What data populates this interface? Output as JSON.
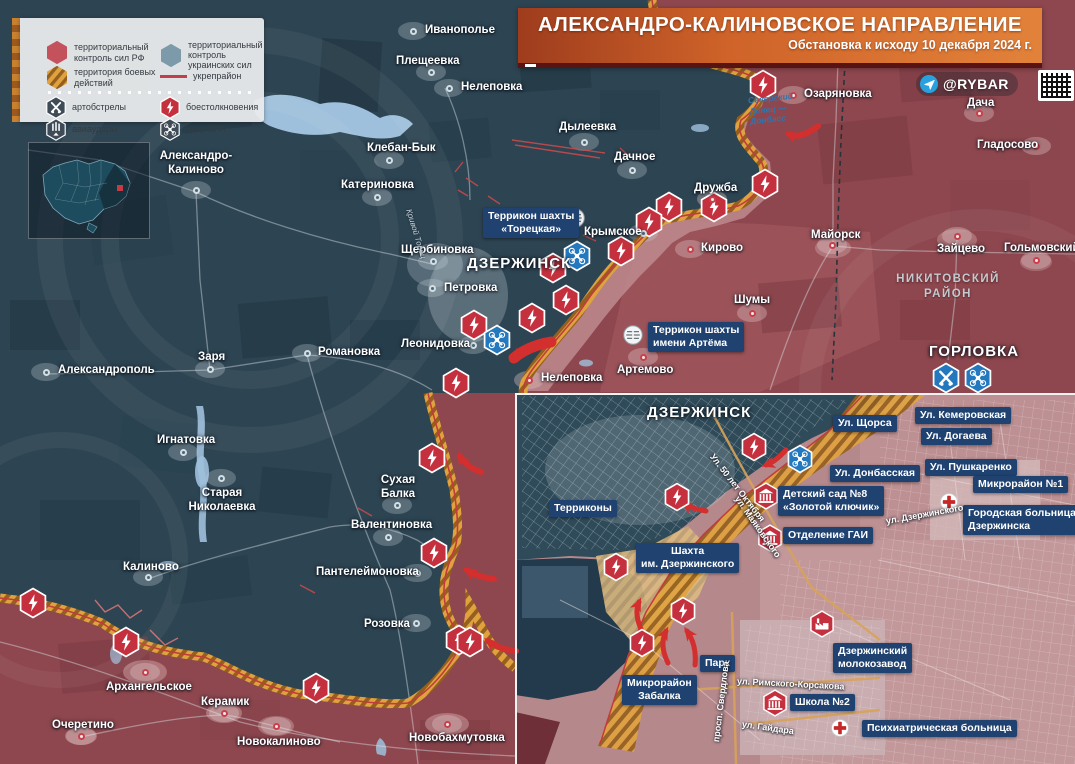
{
  "header": {
    "title": "АЛЕКСАНДРО-КАЛИНОВСКОЕ НАПРАВЛЕНИЕ",
    "subtitle": "Обстановка к исходу 10 декабря 2024 г.",
    "badge": "@RYBAR"
  },
  "legend": {
    "rf_control": "территориальный контроль сил РФ",
    "ua_control": "территориальный контроль украинских сил",
    "combat_zone": "территория боевых действий",
    "fortified": "укрепрайон",
    "artillery": "артобстрелы",
    "clashes": "боестолкновения",
    "airstrikes": "авиаудары",
    "uav": "удар БЛА"
  },
  "colors": {
    "rf_area": "#8e474e",
    "ua_area": "#2d4452",
    "combat_band": "#e0a23f",
    "accent_red": "#c5303e",
    "accent_blue": "#2478bd",
    "box_blue": "#1f4270"
  },
  "map": {
    "cities": [
      {
        "name": "Иванополье",
        "lx": 425,
        "ly": 24,
        "dx": 413,
        "dy": 31,
        "side": "ua"
      },
      {
        "name": "Плещеевка",
        "lx": 396,
        "ly": 55,
        "dx": 431,
        "dy": 72,
        "side": "ua"
      },
      {
        "name": "Нелеповка",
        "lx": 461,
        "ly": 81,
        "dx": 449,
        "dy": 88,
        "side": "ua"
      },
      {
        "name": "Дылеевка",
        "lx": 559,
        "ly": 121,
        "dx": 584,
        "dy": 142,
        "side": "ua"
      },
      {
        "name": "Дачное",
        "lx": 614,
        "ly": 151,
        "dx": 632,
        "dy": 170,
        "side": "ua"
      },
      {
        "name": "Клебан-Бык",
        "lx": 367,
        "ly": 142,
        "dx": 389,
        "dy": 160,
        "side": "ua"
      },
      {
        "name": "Катериновка",
        "lx": 341,
        "ly": 179,
        "dx": 377,
        "dy": 197,
        "side": "ua"
      },
      {
        "lines": [
          "Александро-",
          "Калиново"
        ],
        "lx": 196,
        "ly": 150,
        "dx": 196,
        "dy": 190,
        "side": "ua",
        "align": "center"
      },
      {
        "name": "Дружба",
        "lx": 694,
        "ly": 182,
        "dx": 712,
        "dy": 199,
        "side": "ru"
      },
      {
        "name": "Крымское",
        "lx": 584,
        "ly": 226,
        "dx": 643,
        "dy": 233,
        "side": "ua"
      },
      {
        "name": "Кирово",
        "lx": 701,
        "ly": 242,
        "dx": 690,
        "dy": 249,
        "side": "ru"
      },
      {
        "name": "Майорск",
        "lx": 811,
        "ly": 229,
        "dx": 832,
        "dy": 245,
        "side": "ru"
      },
      {
        "name": "Шумы",
        "lx": 734,
        "ly": 294,
        "dx": 752,
        "dy": 313,
        "side": "ru"
      },
      {
        "name": "Зайцево",
        "lx": 937,
        "ly": 243,
        "dx": 957,
        "dy": 236,
        "side": "ru"
      },
      {
        "name": "Гольмовский",
        "lx": 1004,
        "ly": 242,
        "dx": 1036,
        "dy": 260,
        "side": "ru"
      },
      {
        "name": "Озаряновка",
        "lx": 804,
        "ly": 88,
        "dx": 793,
        "dy": 95,
        "side": "ru"
      },
      {
        "name": "Дача",
        "lx": 967,
        "ly": 97,
        "dx": 979,
        "dy": 113,
        "side": "ru"
      },
      {
        "name": "Гладосово",
        "lx": 977,
        "ly": 139,
        "dx": 1036,
        "dy": 146,
        "side": "ru"
      },
      {
        "name": "Щербиновка",
        "lx": 401,
        "ly": 244,
        "dx": 433,
        "dy": 261,
        "side": "ua"
      },
      {
        "name": "Петровка",
        "lx": 444,
        "ly": 282,
        "dx": 432,
        "dy": 288,
        "side": "ua"
      },
      {
        "name": "Леонидовка",
        "lx": 401,
        "ly": 338,
        "dx": 473,
        "dy": 345,
        "side": "ua"
      },
      {
        "name": "Нелеповка",
        "lx": 541,
        "ly": 372,
        "dx": 529,
        "dy": 380,
        "side": "ru"
      },
      {
        "name": "Артемово",
        "lx": 617,
        "ly": 364,
        "dx": 643,
        "dy": 357,
        "side": "ru"
      },
      {
        "name": "Заря",
        "lx": 198,
        "ly": 351,
        "dx": 210,
        "dy": 369,
        "side": "ua"
      },
      {
        "name": "Александрополь",
        "lx": 58,
        "ly": 364,
        "dx": 46,
        "dy": 372,
        "side": "ua"
      },
      {
        "name": "Романовка",
        "lx": 318,
        "ly": 346,
        "dx": 307,
        "dy": 353,
        "side": "ua"
      },
      {
        "name": "Игнатовка",
        "lx": 157,
        "ly": 434,
        "dx": 183,
        "dy": 452,
        "side": "ua"
      },
      {
        "lines": [
          "Старая",
          "Николаевка"
        ],
        "lx": 222,
        "ly": 487,
        "dx": 221,
        "dy": 478,
        "side": "ua",
        "align": "center"
      },
      {
        "name": "Калиново",
        "lx": 123,
        "ly": 561,
        "dx": 148,
        "dy": 577,
        "side": "ua"
      },
      {
        "lines": [
          "Сухая",
          "Балка"
        ],
        "lx": 398,
        "ly": 474,
        "dx": 397,
        "dy": 505,
        "side": "ua",
        "align": "center"
      },
      {
        "name": "Валентиновка",
        "lx": 351,
        "ly": 519,
        "dx": 388,
        "dy": 537,
        "side": "ua"
      },
      {
        "name": "Пантелеймоновка",
        "lx": 316,
        "ly": 566,
        "dx": 417,
        "dy": 573,
        "side": "ua"
      },
      {
        "name": "Розовка",
        "lx": 364,
        "ly": 618,
        "dx": 416,
        "dy": 623,
        "side": "ua"
      },
      {
        "name": "Архангельское",
        "lx": 106,
        "ly": 681,
        "dx": 145,
        "dy": 672,
        "side": "ru"
      },
      {
        "name": "Керамик",
        "lx": 201,
        "ly": 696,
        "dx": 224,
        "dy": 713,
        "side": "ru"
      },
      {
        "name": "Очеретино",
        "lx": 52,
        "ly": 719,
        "dx": 81,
        "dy": 736,
        "side": "ru"
      },
      {
        "name": "Новокалиново",
        "lx": 237,
        "ly": 736,
        "dx": 276,
        "dy": 726,
        "side": "ru"
      },
      {
        "name": "Новобахмутовка",
        "lx": 409,
        "ly": 732,
        "dx": 447,
        "dy": 724,
        "side": "ru"
      }
    ],
    "big_labels": [
      {
        "name": "ДЗЕРЖИНСК",
        "x": 467,
        "y": 255
      },
      {
        "name": "ГОРЛОВКА",
        "x": 929,
        "y": 343
      }
    ],
    "district": {
      "lines": [
        "НИКИТОВСКИЙ",
        "РАЙОН"
      ],
      "x": 948,
      "y": 272
    },
    "canal": {
      "lines": [
        "Северский",
        "Донец —",
        "Донбасс"
      ],
      "x": 749,
      "y": 93
    },
    "river": "Кривой Торец",
    "poi_boxes": [
      {
        "lines": [
          "Террикон шахты",
          "«Торецкая»"
        ],
        "x": 483,
        "y": 208,
        "align": "center"
      },
      {
        "lines": [
          "Террикон шахты",
          "имени Артёма"
        ],
        "x": 648,
        "y": 322
      }
    ],
    "icons": {
      "clash": [
        [
          763,
          85
        ],
        [
          765,
          184
        ],
        [
          714,
          207
        ],
        [
          669,
          207
        ],
        [
          649,
          222
        ],
        [
          621,
          251
        ],
        [
          553,
          268
        ],
        [
          566,
          300
        ],
        [
          532,
          318
        ],
        [
          474,
          325
        ],
        [
          456,
          383
        ],
        [
          432,
          458
        ],
        [
          434,
          553
        ],
        [
          459,
          640
        ],
        [
          33,
          603
        ],
        [
          126,
          642
        ],
        [
          316,
          688
        ],
        [
          470,
          642
        ]
      ],
      "uav": [
        [
          577,
          256
        ],
        [
          497,
          340
        ],
        [
          978,
          378
        ]
      ],
      "artillery": [
        [
          946,
          378
        ]
      ],
      "terrikon": [
        [
          575,
          218
        ],
        [
          633,
          335
        ]
      ]
    }
  },
  "inset": {
    "title": "ДЗЕРЖИНСК",
    "title_x": 647,
    "title_y": 404,
    "boxes": [
      {
        "lines": [
          "Терриконы"
        ],
        "x": 549,
        "y": 500
      },
      {
        "lines": [
          "Шахта",
          "им. Дзержинского"
        ],
        "x": 636,
        "y": 543,
        "align": "center"
      },
      {
        "lines": [
          "Ул. Щорса"
        ],
        "x": 833,
        "y": 415
      },
      {
        "lines": [
          "Ул. Кемеровская"
        ],
        "x": 915,
        "y": 407
      },
      {
        "lines": [
          "Ул. Догаева"
        ],
        "x": 921,
        "y": 428
      },
      {
        "lines": [
          "Ул. Донбасская"
        ],
        "x": 830,
        "y": 465
      },
      {
        "lines": [
          "Ул. Пушкаренко"
        ],
        "x": 925,
        "y": 459
      },
      {
        "lines": [
          "Микрорайон №1"
        ],
        "x": 973,
        "y": 476
      },
      {
        "lines": [
          "Детский сад №8",
          "«Золотой ключик»"
        ],
        "x": 778,
        "y": 486
      },
      {
        "lines": [
          "Городская больница",
          "Дзержинска"
        ],
        "x": 963,
        "y": 505
      },
      {
        "lines": [
          "Отделение ГАИ"
        ],
        "x": 783,
        "y": 527
      },
      {
        "lines": [
          "Парк"
        ],
        "x": 700,
        "y": 655
      },
      {
        "lines": [
          "Микрорайон",
          "Забалка"
        ],
        "x": 622,
        "y": 675,
        "align": "center"
      },
      {
        "lines": [
          "Школа №2"
        ],
        "x": 790,
        "y": 694
      },
      {
        "lines": [
          "Дзержинский",
          "молокозавод"
        ],
        "x": 833,
        "y": 643
      },
      {
        "lines": [
          "Психиатрическая больница"
        ],
        "x": 862,
        "y": 720
      }
    ],
    "streets": [
      {
        "t": "Ул. 50 лет Октября",
        "x": 712,
        "y": 450,
        "rot": 52
      },
      {
        "t": "ул. Маяковского",
        "x": 737,
        "y": 492,
        "rot": 55
      },
      {
        "t": "ул. Дзержинского",
        "x": 886,
        "y": 516,
        "rot": -10
      },
      {
        "t": "просп. Свердлова",
        "x": 716,
        "y": 737,
        "rot": -83
      },
      {
        "t": "ул. Римского-Корсакова",
        "x": 737,
        "y": 676,
        "rot": 3
      },
      {
        "t": "ул. Гайдара",
        "x": 742,
        "y": 719,
        "rot": 8
      }
    ],
    "icons": {
      "clash": [
        [
          754,
          447
        ],
        [
          677,
          497
        ],
        [
          616,
          567
        ],
        [
          683,
          611
        ],
        [
          642,
          643
        ]
      ],
      "uav": [
        [
          800,
          459
        ]
      ],
      "building": [
        [
          766,
          496
        ],
        [
          770,
          538
        ],
        [
          775,
          703
        ]
      ],
      "factory": [
        [
          822,
          624
        ]
      ],
      "hospital": [
        [
          949,
          502
        ],
        [
          840,
          728
        ]
      ]
    }
  }
}
